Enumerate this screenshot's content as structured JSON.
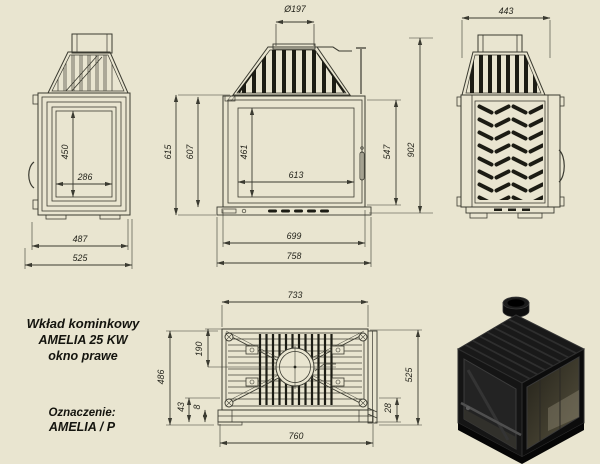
{
  "colors": {
    "background": "#e9e5d0",
    "ink": "#3b3b31",
    "fill": "#1c1c14"
  },
  "title_block": {
    "product": "Wkład kominkowy",
    "model": "AMELIA 25 KW",
    "variant": "okno prawe",
    "designation_label": "Oznaczenie:",
    "designation_value": "AMELIA / P"
  },
  "views": {
    "left_side": {
      "dims": {
        "glass_height": "450",
        "glass_width": "286",
        "body_width": "487",
        "total_width": "525"
      }
    },
    "front": {
      "dims": {
        "flue_diameter": "Ø197",
        "height_outer": "615",
        "height_body": "607",
        "glass_height": "461",
        "glass_width": "613",
        "door_height": "547",
        "total_height": "902",
        "body_width": "699",
        "total_width": "758"
      }
    },
    "right_side": {
      "dims": {
        "depth": "443"
      }
    },
    "top": {
      "dims": {
        "inner_width": "733",
        "flue_offset": "190",
        "depth_body": "486",
        "front_gap_a": "43",
        "front_gap_b": "8",
        "front_gap_c": "28",
        "depth_total": "525",
        "total_width": "760"
      }
    }
  }
}
